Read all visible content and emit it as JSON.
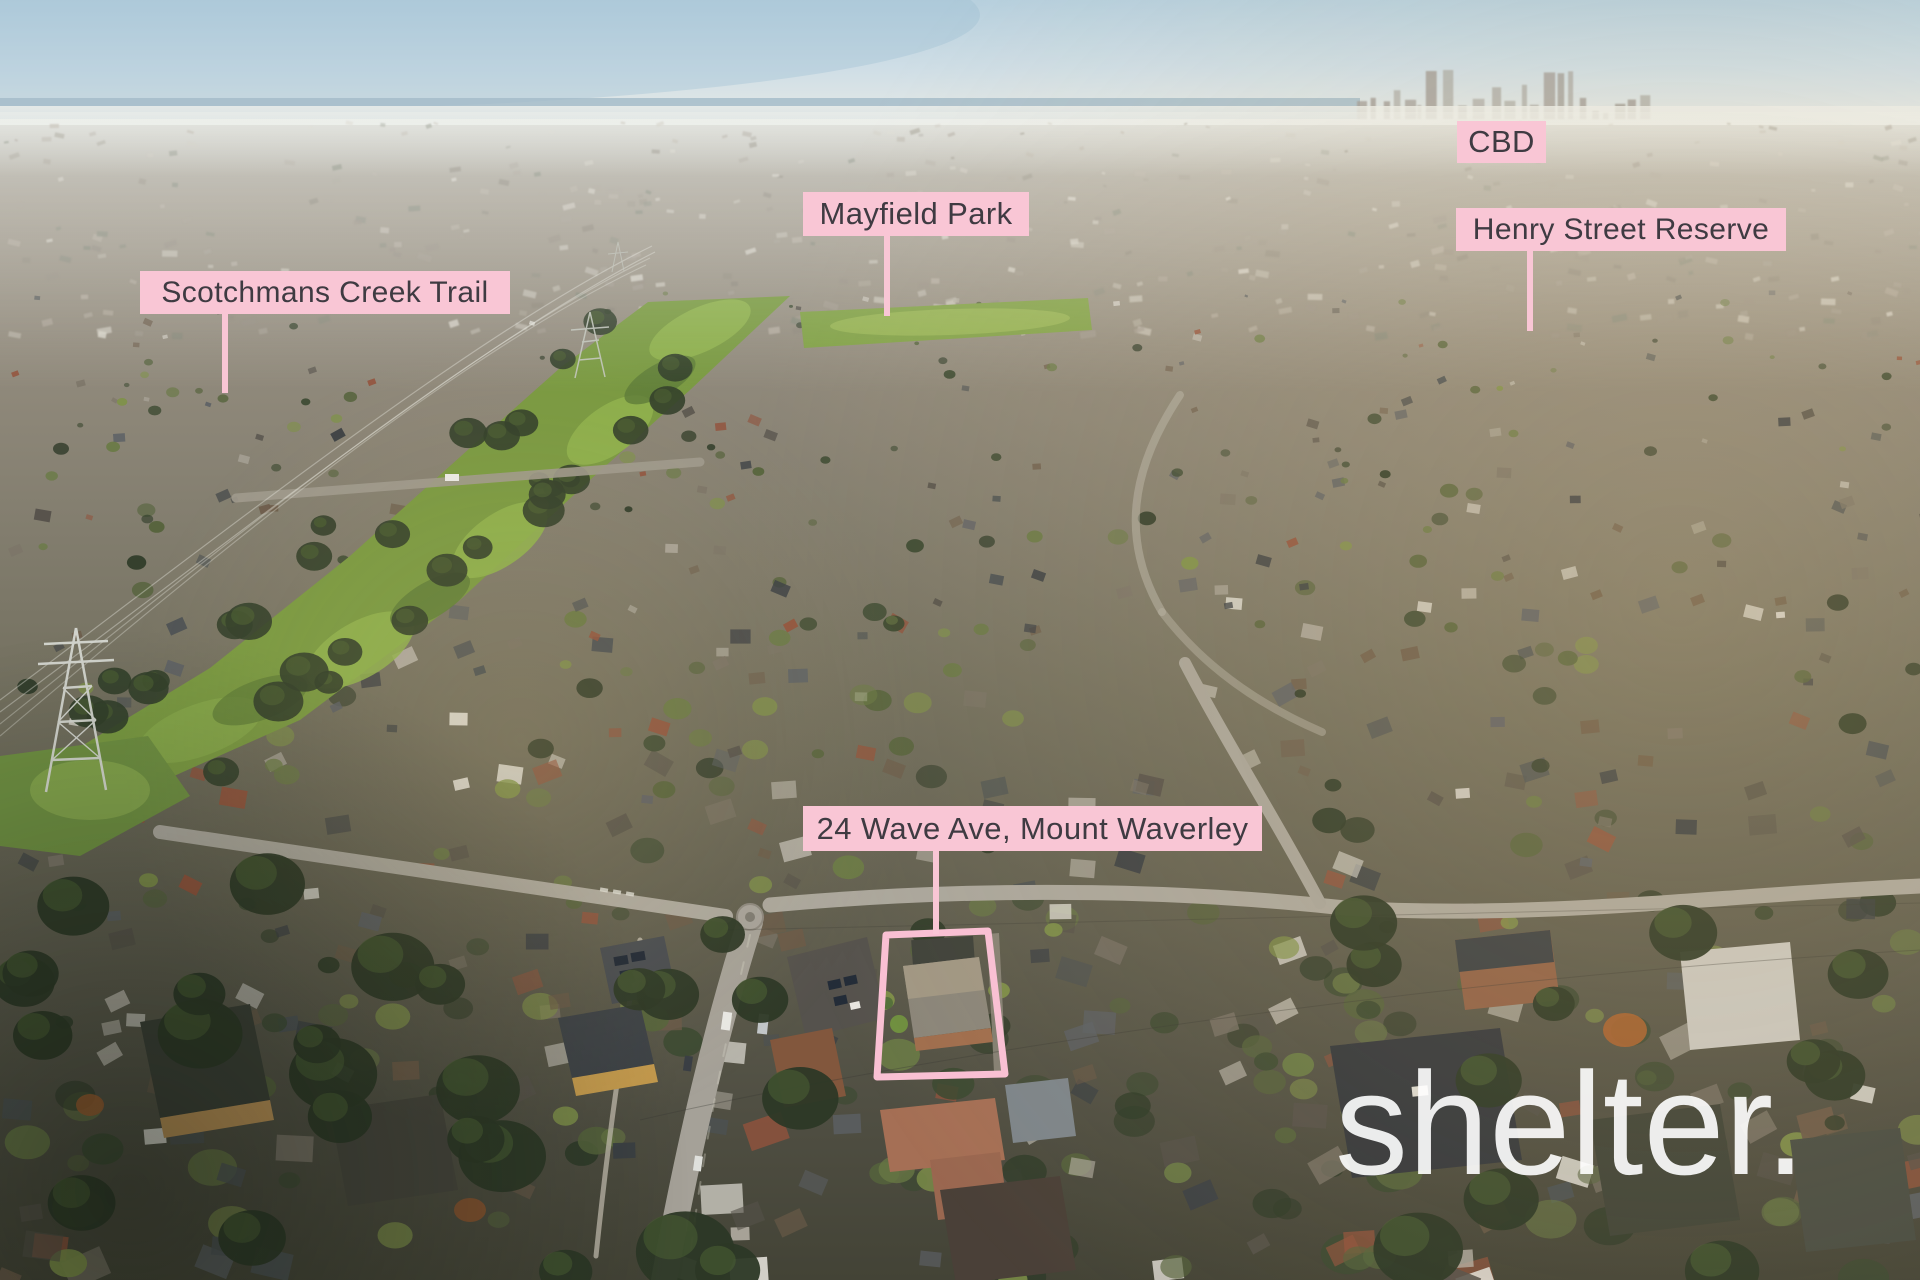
{
  "page": {
    "type": "aerial-property-photo"
  },
  "annotations": {
    "labels": [
      {
        "id": "scotchmans-creek-trail",
        "text": "Scotchmans Creek Trail"
      },
      {
        "id": "mayfield-park",
        "text": "Mayfield Park"
      },
      {
        "id": "cbd",
        "text": "CBD"
      },
      {
        "id": "henry-street-reserve",
        "text": "Henry Street Reserve"
      },
      {
        "id": "property-address",
        "text": "24 Wave Ave, Mount Waverley"
      }
    ],
    "watermark_text": "shelter."
  },
  "colors": {
    "label_background": "#f9c6d5",
    "label_text": "#3f3b42",
    "boundary_outline": "#f9c0d3",
    "watermark": "#ffffff"
  }
}
